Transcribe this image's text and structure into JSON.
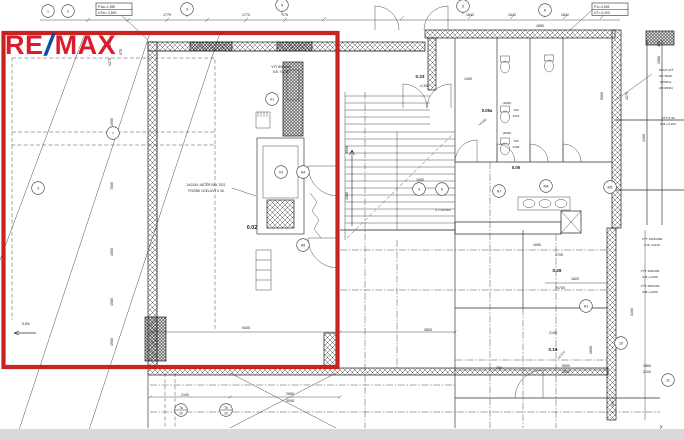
{
  "logo": {
    "re": "RE",
    "slash": "/",
    "max": "MAX",
    "red": "#dc1c2e",
    "blue": "#0b4ea2"
  },
  "highlight": {
    "color": "#c9231f"
  },
  "plan": {
    "boxes": [
      {
        "x": 96,
        "y": 3,
        "rows": [
          "P1a=-1,390",
          "UTm=-1,500"
        ]
      },
      {
        "x": 592,
        "y": 3,
        "rows": [
          "P1=-0,245",
          "UT=-0,400"
        ]
      }
    ],
    "markers": [
      {
        "x": 48,
        "y": 11,
        "t": "1"
      },
      {
        "x": 68,
        "y": 11,
        "t": "2"
      },
      {
        "x": 187,
        "y": 9,
        "t": "3"
      },
      {
        "x": 282,
        "y": 5,
        "t": "4"
      },
      {
        "x": 463,
        "y": 6,
        "t": "5"
      },
      {
        "x": 545,
        "y": 10,
        "t": "6"
      },
      {
        "x": 38,
        "y": 188,
        "t": "3"
      },
      {
        "x": 113,
        "y": 133,
        "t": "7"
      },
      {
        "x": 303,
        "y": 172,
        "t": "H4"
      },
      {
        "x": 303,
        "y": 245,
        "t": "H5"
      },
      {
        "x": 181,
        "y": 410,
        "t": "7a",
        "sub": "20"
      },
      {
        "x": 226,
        "y": 410,
        "t": "7b",
        "sub": "20"
      },
      {
        "x": 419,
        "y": 189,
        "t": "4"
      },
      {
        "x": 442,
        "y": 189,
        "t": "5"
      },
      {
        "x": 499,
        "y": 191,
        "t": "N7"
      },
      {
        "x": 546,
        "y": 186,
        "t": "M4"
      },
      {
        "x": 610,
        "y": 187,
        "t": "M5"
      },
      {
        "x": 621,
        "y": 343,
        "t": "10"
      },
      {
        "x": 586,
        "y": 306,
        "t": "H1"
      },
      {
        "x": 668,
        "y": 380,
        "t": "11"
      },
      {
        "x": 281,
        "y": 172,
        "t": "V3"
      },
      {
        "x": 272,
        "y": 99,
        "t": "V1"
      }
    ],
    "texts": [
      {
        "x": 167,
        "y": 16,
        "t": "1779"
      },
      {
        "x": 246,
        "y": 16,
        "t": "1770"
      },
      {
        "x": 285,
        "y": 16,
        "t": "175"
      },
      {
        "x": 470,
        "y": 16,
        "t": "1642"
      },
      {
        "x": 512,
        "y": 16,
        "t": "1642"
      },
      {
        "x": 565,
        "y": 16,
        "t": "1642"
      },
      {
        "x": 111,
        "y": 44,
        "t": "350",
        "r": -90
      },
      {
        "x": 111,
        "y": 62,
        "t": "1275",
        "r": -90
      },
      {
        "x": 122,
        "y": 52,
        "t": "975",
        "r": -90
      },
      {
        "x": 113,
        "y": 122,
        "t": "1950",
        "r": -90
      },
      {
        "x": 113,
        "y": 186,
        "t": "7800",
        "r": -90
      },
      {
        "x": 113,
        "y": 252,
        "t": "1950",
        "r": -90
      },
      {
        "x": 113,
        "y": 302,
        "t": "1080",
        "r": -90
      },
      {
        "x": 113,
        "y": 342,
        "t": "1950",
        "r": -90
      },
      {
        "x": 348,
        "y": 150,
        "t": "2936",
        "r": -90
      },
      {
        "x": 348,
        "y": 196,
        "t": "1080",
        "r": -90
      },
      {
        "x": 603,
        "y": 96,
        "t": "5000",
        "r": -90
      },
      {
        "x": 628,
        "y": 96,
        "t": "4270",
        "r": -90
      },
      {
        "x": 645,
        "y": 138,
        "t": "1460",
        "r": -90
      },
      {
        "x": 660,
        "y": 60,
        "t": "1580",
        "r": -90
      },
      {
        "x": 660,
        "y": 44,
        "t": "450",
        "r": -90
      },
      {
        "x": 633,
        "y": 312,
        "t": "3400",
        "r": -90
      },
      {
        "x": 592,
        "y": 350,
        "t": "2690",
        "r": -90
      },
      {
        "x": 614,
        "y": 404,
        "t": "450",
        "r": -90
      },
      {
        "x": 252,
        "y": 229,
        "t": "0.02",
        "s": 5.4,
        "b": 1
      },
      {
        "x": 420,
        "y": 78,
        "t": "0.23",
        "s": 4.6,
        "b": 1
      },
      {
        "x": 487,
        "y": 112,
        "t": "0.05a",
        "s": 4.2,
        "b": 1
      },
      {
        "x": 516,
        "y": 169,
        "t": "0.06",
        "s": 4.2,
        "b": 1
      },
      {
        "x": 557,
        "y": 272,
        "t": "0.29",
        "s": 4.6,
        "b": 1
      },
      {
        "x": 553,
        "y": 351,
        "t": "0.19",
        "s": 4.6,
        "b": 1
      },
      {
        "x": 424,
        "y": 87,
        "t": "-0,300",
        "s": 3.2
      },
      {
        "x": 281,
        "y": 68,
        "t": "VÝT 800x660",
        "s": 3.2
      },
      {
        "x": 281,
        "y": 73,
        "t": "S.B. +2,700",
        "s": 3.2
      },
      {
        "x": 206,
        "y": 186,
        "t": "2x2/140, NÁTĚR RAL 7021",
        "s": 3.2
      },
      {
        "x": 206,
        "y": 192,
        "t": "POZINK OCELOVÝ # 45",
        "s": 3.2
      },
      {
        "x": 666,
        "y": 71,
        "t": "NOVÁ SÍŤ",
        "s": 3.1
      },
      {
        "x": 666,
        "y": 77,
        "t": "NA TRAP.",
        "s": 3.1
      },
      {
        "x": 666,
        "y": 83,
        "t": "PROFIL",
        "s": 3.1
      },
      {
        "x": 666,
        "y": 89,
        "t": "(POZINK)",
        "s": 3.1
      },
      {
        "x": 668,
        "y": 119,
        "t": "VÝT # 40",
        "s": 3.1
      },
      {
        "x": 668,
        "y": 125,
        "t": "S.B.+3,100",
        "s": 3.1
      },
      {
        "x": 652,
        "y": 240,
        "t": "VÝT 1200x580",
        "s": 3.1
      },
      {
        "x": 652,
        "y": 246,
        "t": "S.B.+3,010",
        "s": 3.1
      },
      {
        "x": 650,
        "y": 272,
        "t": "VÝT 400x300",
        "s": 3.1
      },
      {
        "x": 650,
        "y": 278,
        "t": "S.B.+3,050",
        "s": 3.1
      },
      {
        "x": 650,
        "y": 287,
        "t": "VÝT 250x200",
        "s": 3.1
      },
      {
        "x": 650,
        "y": 293,
        "t": "S.B.+3,050",
        "s": 3.1
      },
      {
        "x": 26,
        "y": 325,
        "t": "5,5%",
        "s": 3.4
      },
      {
        "x": 483,
        "y": 123,
        "t": "+4,300",
        "r": -38,
        "s": 3.2
      },
      {
        "x": 562,
        "y": 356,
        "t": "+4,270",
        "r": -48,
        "s": 3.2
      },
      {
        "x": 443,
        "y": 211,
        "t": "2 x 12x162",
        "s": 3.1
      },
      {
        "x": 246,
        "y": 329,
        "t": "5400"
      },
      {
        "x": 428,
        "y": 331,
        "t": "2800"
      },
      {
        "x": 559,
        "y": 256,
        "t": "2700"
      },
      {
        "x": 537,
        "y": 246,
        "t": "1650"
      },
      {
        "x": 553,
        "y": 334,
        "t": "2150"
      },
      {
        "x": 575,
        "y": 280,
        "t": "1820"
      },
      {
        "x": 560,
        "y": 289,
        "t": "2x700"
      },
      {
        "x": 499,
        "y": 369,
        "t": "750"
      },
      {
        "x": 566,
        "y": 367,
        "t": "5900"
      },
      {
        "x": 566,
        "y": 373,
        "t": "3600"
      },
      {
        "x": 647,
        "y": 367,
        "t": "1860"
      },
      {
        "x": 647,
        "y": 373,
        "t": "2100"
      },
      {
        "x": 185,
        "y": 396,
        "t": "2100"
      },
      {
        "x": 290,
        "y": 395,
        "t": "2850"
      },
      {
        "x": 290,
        "y": 402,
        "t": "3006"
      },
      {
        "x": 420,
        "y": 181,
        "t": "1650"
      },
      {
        "x": 468,
        "y": 80,
        "t": "1400"
      },
      {
        "x": 540,
        "y": 27,
        "t": "1850"
      },
      {
        "x": 507,
        "y": 104,
        "t": "(2000)",
        "s": 3
      },
      {
        "x": 507,
        "y": 134,
        "t": "(2000)",
        "s": 3
      },
      {
        "x": 516,
        "y": 111,
        "t": "700",
        "s": 3
      },
      {
        "x": 516,
        "y": 117,
        "t": "1970",
        "s": 3
      },
      {
        "x": 516,
        "y": 142,
        "t": "700",
        "s": 3
      },
      {
        "x": 516,
        "y": 148,
        "t": "2100",
        "s": 3
      },
      {
        "x": 661,
        "y": 429,
        "t": "›",
        "s": 8,
        "n": "chevron-right-icon"
      }
    ]
  }
}
